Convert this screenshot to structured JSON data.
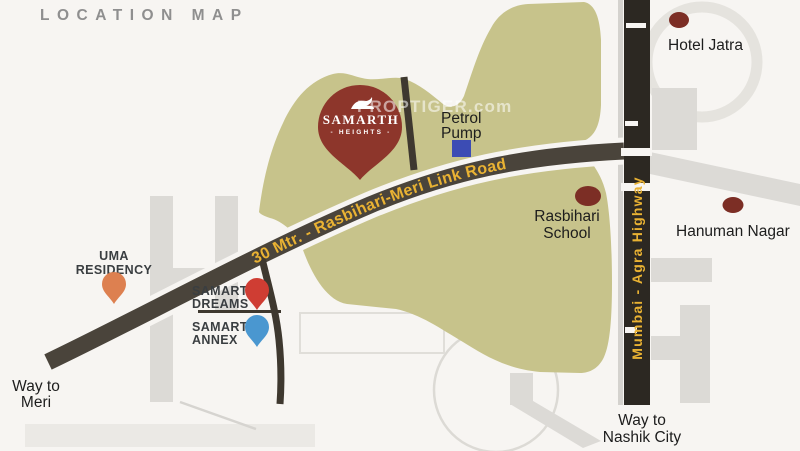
{
  "title": "LOCATION MAP",
  "watermark": "PROPTIGER.com",
  "colors": {
    "background": "#f7f5f2",
    "parcel_green": "#c7c38b",
    "link_road": "#4a443b",
    "side_road": "#3e382f",
    "highway": "#2c2822",
    "road_label_gold": "#e9b233",
    "gray_road": "#dcdad6",
    "gray_road_light": "#ebe9e5",
    "project_red": "#8d362b",
    "landmark_maroon": "#7c2e25",
    "petrol_blue": "#3c4cb4",
    "uma_orange": "#dd8050",
    "dreams_red": "#cf3d33",
    "annex_blue": "#4a97d0",
    "title_gray": "#8f8f8f"
  },
  "roads": {
    "link_road_label": "30 Mtr. - Rasbihari-Meri Link Road",
    "highway_label": "Mumbai - Agra Highway"
  },
  "project": {
    "name": "SAMARTH",
    "subname": "- HEIGHTS -"
  },
  "landmarks": {
    "petrol_pump": {
      "line1": "Petrol",
      "line2": "Pump"
    },
    "hotel_jatra": {
      "label": "Hotel Jatra"
    },
    "rasbihari_school": {
      "line1": "Rasbihari",
      "line2": "School"
    },
    "hanuman_nagar": {
      "label": "Hanuman Nagar"
    },
    "uma_residency": {
      "line1": "UMA",
      "line2": "RESIDENCY"
    },
    "samarth_dreams": {
      "line1": "SAMARTH",
      "line2": "DREAMS"
    },
    "samarth_annex": {
      "line1": "SAMARTH",
      "line2": "ANNEX"
    }
  },
  "directions": {
    "way_to_meri": {
      "line1": "Way to",
      "line2": "Meri"
    },
    "way_to_nashik": {
      "line1": "Way to",
      "line2": "Nashik City"
    }
  }
}
